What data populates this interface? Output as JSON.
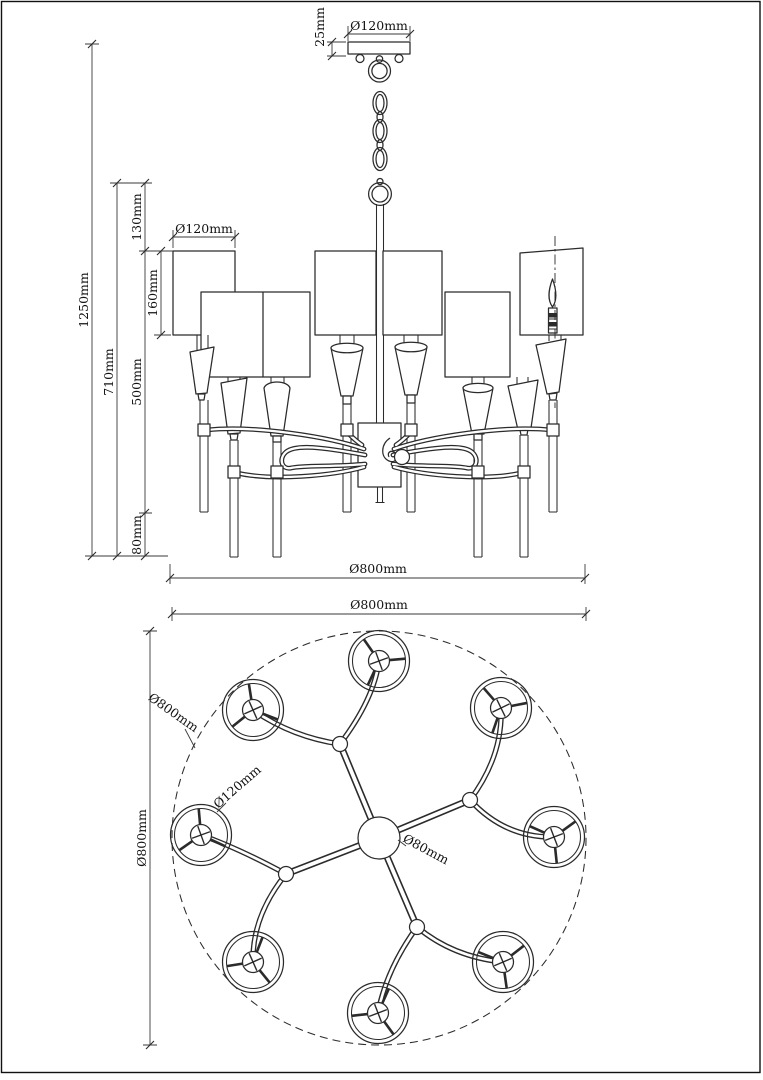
{
  "elevation": {
    "canopy_diameter": "Ø120mm",
    "canopy_height": "25mm",
    "overall_height": "1250mm",
    "body_height": "710mm",
    "top_to_shade": "130mm",
    "shade_height": "160mm",
    "shade_to_tip": "500mm",
    "tip_length": "80mm",
    "shade_diameter": "Ø120mm",
    "body_diameter": "Ø800mm"
  },
  "plan": {
    "overall_diameter_top": "Ø800mm",
    "overall_diameter_side": "Ø800mm",
    "outer_circle_diameter": "Ø800mm",
    "shade_diameter": "Ø120mm",
    "hub_diameter": "Ø80mm"
  }
}
